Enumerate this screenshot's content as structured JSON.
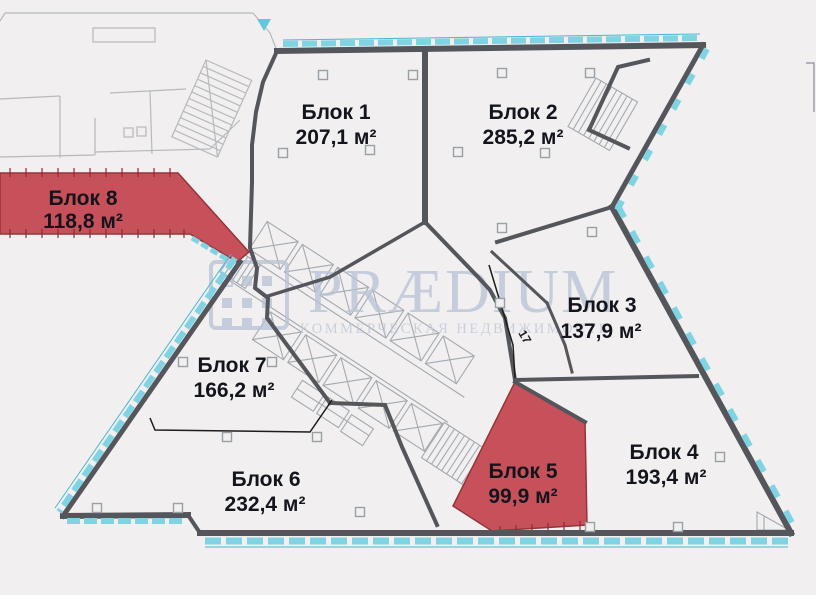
{
  "watermark": {
    "brand": "PRÆDIUM",
    "tagline": "КОММЕРЧЕСКАЯ НЕДВИЖИМОСТЬ"
  },
  "annotations": {
    "room_number": "17"
  },
  "blocks": [
    {
      "name": "Блок 1",
      "area": "207,1 м²",
      "highlighted": false
    },
    {
      "name": "Блок 2",
      "area": "285,2 м²",
      "highlighted": false
    },
    {
      "name": "Блок 3",
      "area": "137,9 м²",
      "highlighted": false
    },
    {
      "name": "Блок 4",
      "area": "193,4 м²",
      "highlighted": false
    },
    {
      "name": "Блок 5",
      "area": "99,9 м²",
      "highlighted": true
    },
    {
      "name": "Блок 6",
      "area": "232,4 м²",
      "highlighted": false
    },
    {
      "name": "Блок 7",
      "area": "166,2 м²",
      "highlighted": false
    },
    {
      "name": "Блок 8",
      "area": "118,8 м²",
      "highlighted": true
    }
  ],
  "colors": {
    "highlight": "#c7515a",
    "wall": "#54565b",
    "window": "#7fd3e3",
    "watermark": "#b9c3d6",
    "background": "#f1efef",
    "label": "#14141c"
  }
}
